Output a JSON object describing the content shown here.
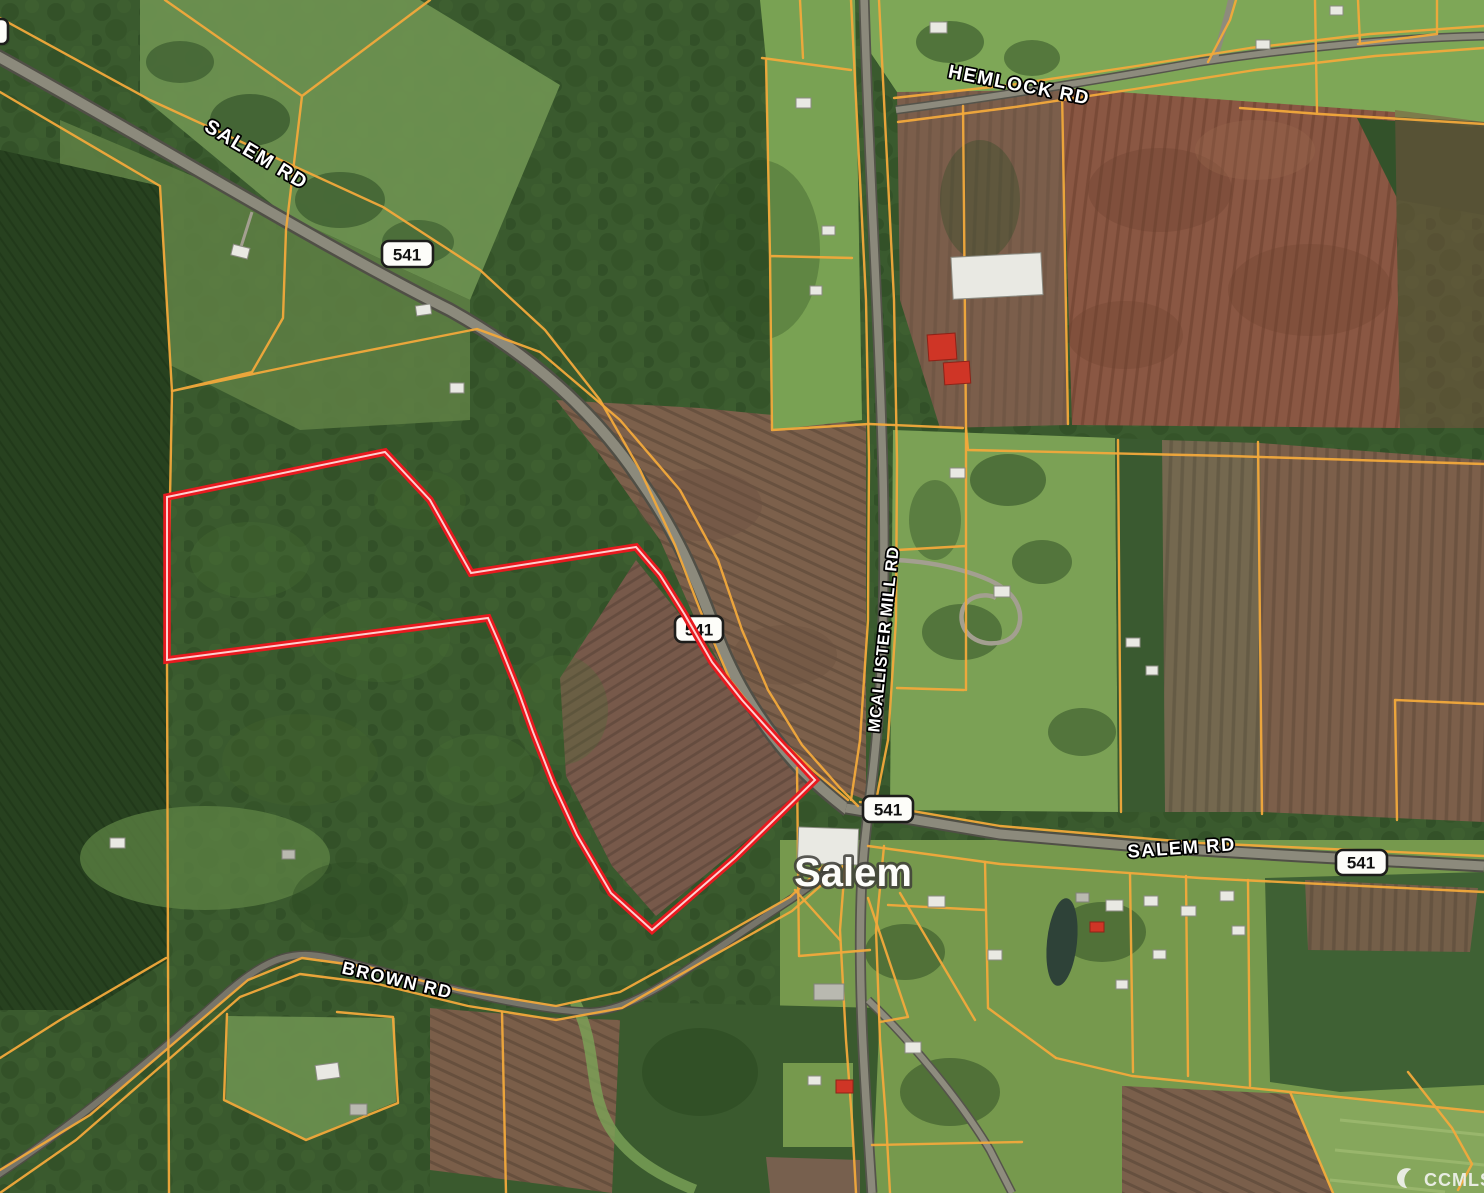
{
  "map": {
    "town_label": "Salem",
    "roads": {
      "salem_rd_west": "SALEM RD",
      "hemlock_rd": "HEMLOCK RD",
      "mcallister_mill_rd": "MCALLISTER MILL RD",
      "salem_rd_east": "SALEM RD",
      "brown_rd": "BROWN RD"
    },
    "route_shields": {
      "northwest": "541",
      "central": "541",
      "intersection": "541",
      "east": "541",
      "edge_clipped": ""
    },
    "watermark": {
      "text": "CCMLS"
    },
    "colors": {
      "subject_boundary": "#e8191f",
      "parcel_line": "#f2a93b",
      "forest_green": "#355429",
      "field_green": "#79a253",
      "plowed_brown": "#7c604b",
      "plowed_red_brown": "#8a5743",
      "road_gray": "#8c8a7c"
    }
  }
}
